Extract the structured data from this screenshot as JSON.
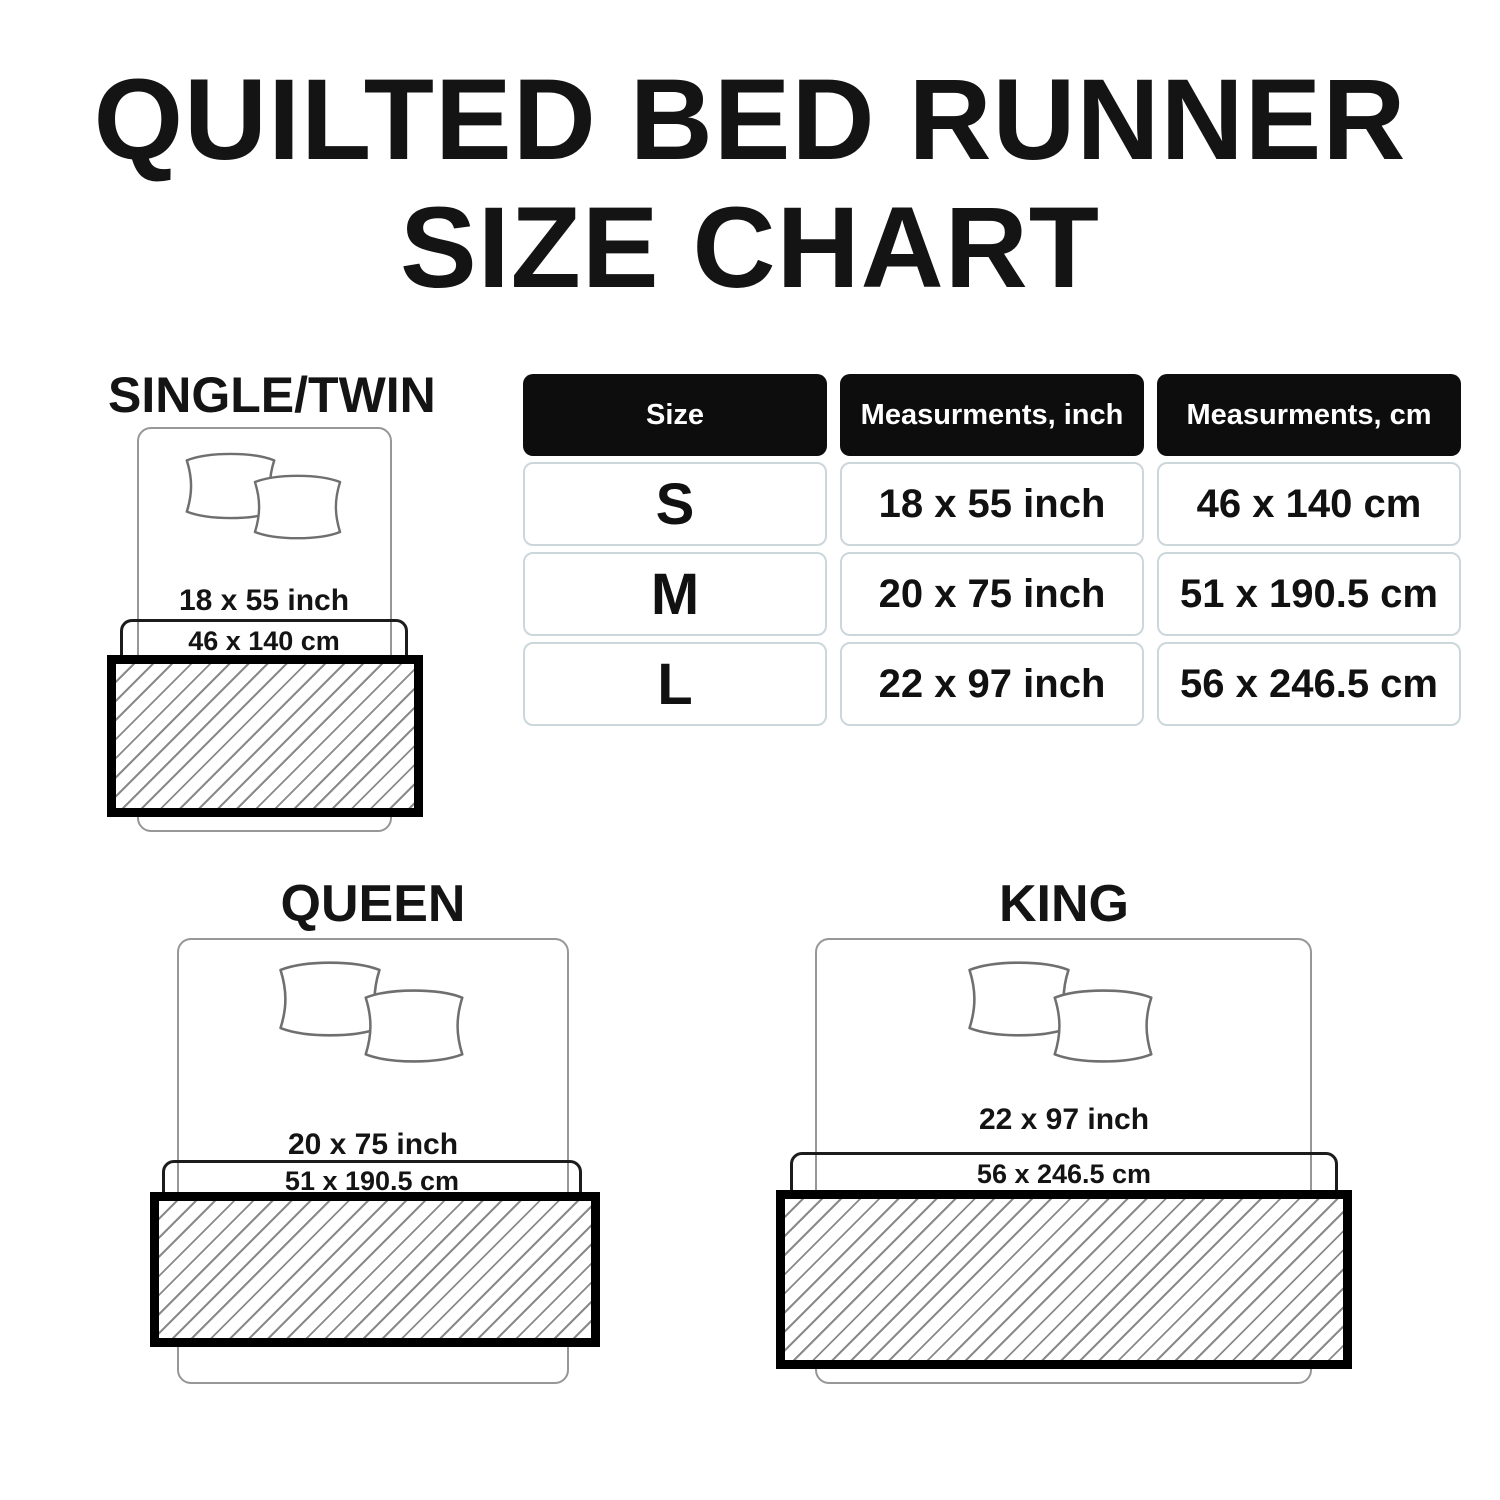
{
  "title": {
    "line1": "QUILTED BED RUNNER",
    "line2": "SIZE CHART"
  },
  "table": {
    "headers": [
      "Size",
      "Measurments, inch",
      "Measurments, cm"
    ],
    "rows": [
      {
        "size": "S",
        "inch": "18 x 55 inch",
        "cm": "46 x 140 cm"
      },
      {
        "size": "M",
        "inch": "20 x 75 inch",
        "cm": "51 x 190.5 cm"
      },
      {
        "size": "L",
        "inch": "22 x 97 inch",
        "cm": "56 x 246.5 cm"
      }
    ]
  },
  "diagrams": [
    {
      "label": "SINGLE/TWIN",
      "inch": "18 x 55 inch",
      "cm": "46 x 140 cm"
    },
    {
      "label": "QUEEN",
      "inch": "20 x 75 inch",
      "cm": "51 x 190.5 cm"
    },
    {
      "label": "KING",
      "inch": "22 x 97 inch",
      "cm": "56 x 246.5 cm"
    }
  ],
  "colors": {
    "text": "#141414",
    "header_bg": "#0d0d0d",
    "header_text": "#ffffff",
    "cell_border": "#ccd7db",
    "bed_outline": "#979797",
    "pillow_outline": "#6f6f6f",
    "dimension_box_border": "#1c1c1c",
    "runner_border": "#000000",
    "hatch_line": "#8a8a8a"
  }
}
